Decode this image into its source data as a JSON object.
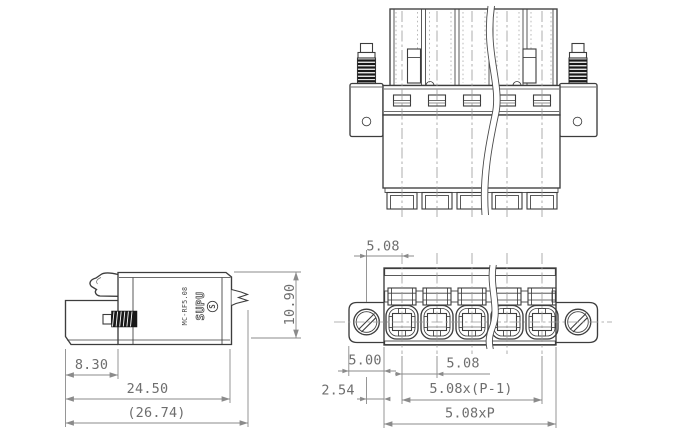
{
  "drawing": {
    "pole_count": 5
  },
  "branding": {
    "manufacturer": "SUPU",
    "model": "MC-RF5.08",
    "logo_mark": "S"
  },
  "dims": {
    "side_wire_section_width": "8.30",
    "side_body_width": "24.50",
    "side_overall_width": "(26.74)",
    "side_height": "10.90",
    "screw_to_first_pole": "5.08",
    "flange_edge_to_body": "5.00",
    "half_pitch": "2.54",
    "pitch": "5.08",
    "span_poles": "5.08x(P-1)",
    "span_total": "5.08xP"
  },
  "colors": {
    "background": "#ffffff",
    "object_line": "#3d3d3d",
    "dimension_line": "#8b8b8b",
    "text": "#6e6e6e",
    "thread_dark": "#1a1a1a"
  }
}
